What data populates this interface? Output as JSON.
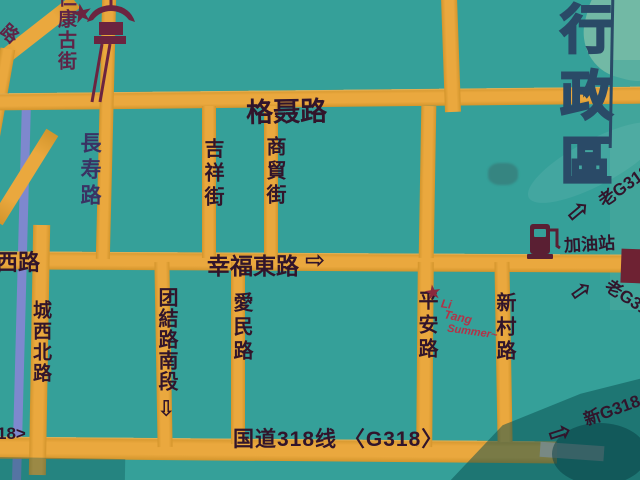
{
  "map": {
    "district_panel": {
      "label": "行政區"
    },
    "roads_horizontal": {
      "genie": {
        "label": "格聂路"
      },
      "xingfu": {
        "label": "幸福東路",
        "arrow": "⇨"
      },
      "g318": {
        "label": "国道318线 〈G318〉"
      }
    },
    "roads_vertical": {
      "changshou": {
        "label": "長寿路"
      },
      "jixiang": {
        "label": "吉祥街"
      },
      "shangmao": {
        "label": "商貿街"
      },
      "chengxibei": {
        "label": "城西北路"
      },
      "tuanjie": {
        "label": "团結路南段",
        "arrow": "⇩"
      },
      "aimin": {
        "label": "愛民路"
      },
      "pingan": {
        "label": "平安路"
      },
      "xincun": {
        "label": "新村路"
      }
    },
    "partial_labels": {
      "west_road": "西路",
      "top_left_road": "路",
      "bottom_left_g318": "18>"
    },
    "poi": {
      "gas_station": {
        "label": "加油站",
        "icon": "fuel-pump-icon"
      },
      "landmark": {
        "label": "仁康古街",
        "icon": "pagoda-monument-icon",
        "star": "★"
      }
    },
    "highway_signs": {
      "old_g318_top": {
        "label": "老G318",
        "arrow": "⇨"
      },
      "old_g318_mid": {
        "label": "老G318",
        "arrow": "⇨"
      },
      "new_g318": {
        "label": "新G318",
        "arrow": "⇨"
      }
    },
    "signature": {
      "star": "★",
      "line1": "Li",
      "line2": "Tang",
      "line3": "Summer~"
    },
    "icons": {
      "arrow_right": "⇨",
      "arrow_down": "⇩",
      "star": "★"
    },
    "colors": {
      "background_teal": "#35A099",
      "road_yellow": "#EAA83E",
      "ink_dark": "#31152B",
      "river_blue": "#7E88CE",
      "district_outline_navy": "#2A4A67",
      "signature_red": "#B23347",
      "landmark_maroon": "#6B2440",
      "shadow_teal": "#135F63"
    }
  }
}
